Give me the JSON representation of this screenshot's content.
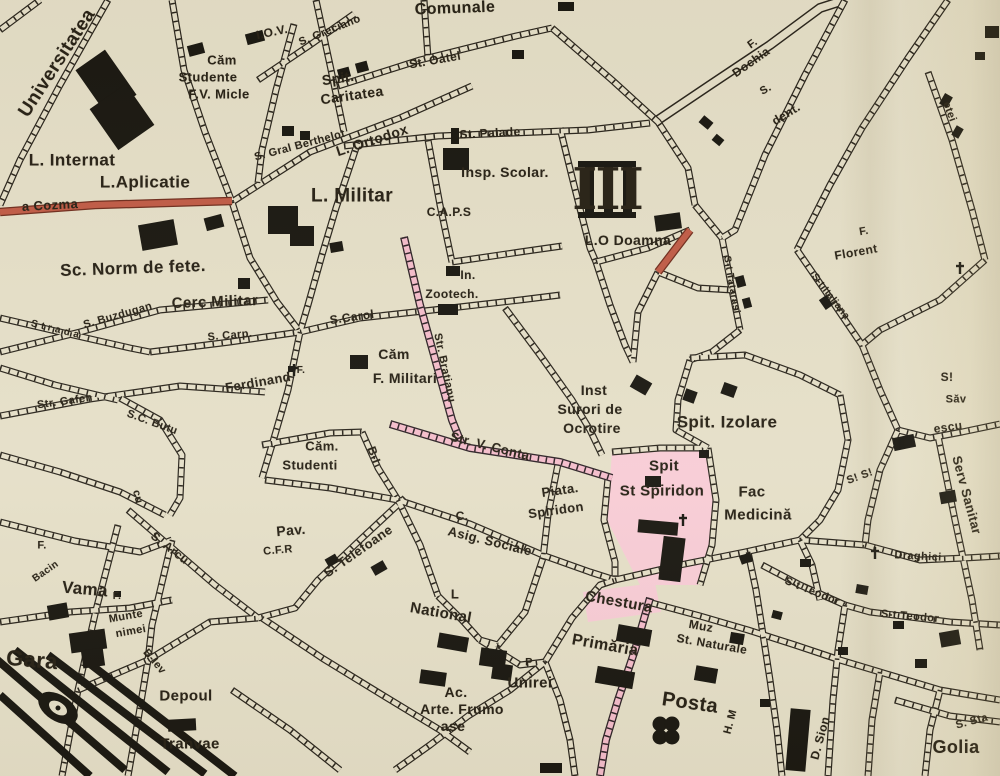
{
  "map": {
    "title": "Vintage city map sheet (Iasi) - district III",
    "background_color": "#e5dfc8",
    "ink_color": "#27221a",
    "highlight_pink_street": "#f4bccb",
    "highlight_pink_area": "#f8ccd6",
    "road_red": "#c05a45",
    "labels": [
      {
        "name": "label-universitatea",
        "t": "Universitatea",
        "x": 57,
        "y": 63,
        "r": -57,
        "s": 19
      },
      {
        "name": "label-iov",
        "t": "I.O.V.",
        "x": 272,
        "y": 32,
        "r": -12,
        "s": 12
      },
      {
        "name": "label-cam-studente-1",
        "t": "Căm",
        "x": 222,
        "y": 60,
        "r": 0,
        "s": 13
      },
      {
        "name": "label-cam-studente-2",
        "t": "Studente",
        "x": 208,
        "y": 77,
        "r": 0,
        "s": 13
      },
      {
        "name": "label-cam-studente-3",
        "t": "F.V. Micle",
        "x": 219,
        "y": 94,
        "r": 0,
        "s": 13
      },
      {
        "name": "label-l-internat",
        "t": "L. Internat",
        "x": 72,
        "y": 160,
        "r": 0,
        "s": 17
      },
      {
        "name": "label-l-aplicatie",
        "t": "L.Aplicatie",
        "x": 145,
        "y": 182,
        "r": 0,
        "s": 17
      },
      {
        "name": "street-name-a-cozma",
        "t": "a Cozma",
        "x": 50,
        "y": 205,
        "r": -3,
        "s": 13
      },
      {
        "name": "label-sc-norm-de-fete",
        "t": "Sc. Norm de fete.",
        "x": 133,
        "y": 268,
        "r": -2,
        "s": 17
      },
      {
        "name": "label-cerc-militar",
        "t": "Cerc Militar",
        "x": 215,
        "y": 302,
        "r": -2,
        "s": 15
      },
      {
        "name": "label-comunale",
        "t": "Comunale",
        "x": 455,
        "y": 9,
        "r": -2,
        "s": 16
      },
      {
        "name": "street-name-greciano",
        "t": "S. Greciano",
        "x": 330,
        "y": 31,
        "r": -22,
        "s": 11
      },
      {
        "name": "label-spit-caritatea-1",
        "t": "Spit.",
        "x": 338,
        "y": 78,
        "r": -8,
        "s": 14
      },
      {
        "name": "label-spit-caritatea-2",
        "t": "Caritatea",
        "x": 352,
        "y": 95,
        "r": -8,
        "s": 14
      },
      {
        "name": "street-name-berthelot",
        "t": "S. Gral Berthelot",
        "x": 300,
        "y": 146,
        "r": -15,
        "s": 11
      },
      {
        "name": "street-name-oatel",
        "t": "St. Oatel",
        "x": 435,
        "y": 60,
        "r": -10,
        "s": 12
      },
      {
        "name": "street-name-palade",
        "t": "St. Palade",
        "x": 490,
        "y": 133,
        "r": -3,
        "s": 12
      },
      {
        "name": "label-l-ortodox",
        "t": "L. Ortodox",
        "x": 372,
        "y": 140,
        "r": -18,
        "s": 14
      },
      {
        "name": "label-l-militar",
        "t": "L. Militar",
        "x": 352,
        "y": 196,
        "r": 0,
        "s": 19
      },
      {
        "name": "label-insp-scolar",
        "t": "Insp. Scolar.",
        "x": 505,
        "y": 172,
        "r": 0,
        "s": 14
      },
      {
        "name": "label-district-iii",
        "t": "III",
        "x": 607,
        "y": 189,
        "r": 0,
        "s": 54,
        "serif": true
      },
      {
        "name": "label-lo-doamna",
        "t": "L.O Doamna",
        "x": 628,
        "y": 240,
        "r": 0,
        "s": 14
      },
      {
        "name": "label-f-dochia-1",
        "t": "F.",
        "x": 753,
        "y": 44,
        "r": -35,
        "s": 11
      },
      {
        "name": "label-f-dochia-2",
        "t": "Dochia",
        "x": 751,
        "y": 62,
        "r": -35,
        "s": 12
      },
      {
        "name": "label-s-dent-1",
        "t": "S.",
        "x": 766,
        "y": 90,
        "r": -30,
        "s": 11
      },
      {
        "name": "label-s-dent-2",
        "t": "dent.",
        "x": 786,
        "y": 114,
        "r": -32,
        "s": 12
      },
      {
        "name": "street-name-etei",
        "t": "etei",
        "x": 949,
        "y": 112,
        "r": 70,
        "s": 11
      },
      {
        "name": "label-f-florent-1",
        "t": "F.",
        "x": 864,
        "y": 232,
        "r": -10,
        "s": 11
      },
      {
        "name": "label-f-florent-2",
        "t": "Florent",
        "x": 856,
        "y": 252,
        "r": -10,
        "s": 12
      },
      {
        "name": "label-caps",
        "t": "C.A.P.S",
        "x": 449,
        "y": 212,
        "r": 0,
        "s": 12
      },
      {
        "name": "label-in-zootech-1",
        "t": "In.",
        "x": 468,
        "y": 275,
        "r": 0,
        "s": 12
      },
      {
        "name": "label-in-zootech-2",
        "t": "Zootech.",
        "x": 452,
        "y": 294,
        "r": 0,
        "s": 12
      },
      {
        "name": "street-name-carol",
        "t": "S.Carol",
        "x": 352,
        "y": 317,
        "r": -8,
        "s": 12
      },
      {
        "name": "street-name-buzdugan",
        "t": "S. Buzdugan",
        "x": 118,
        "y": 316,
        "r": -16,
        "s": 11
      },
      {
        "name": "street-name-carp",
        "t": "S. Carp.",
        "x": 230,
        "y": 336,
        "r": -5,
        "s": 11
      },
      {
        "name": "street-name-strada",
        "t": "S t r a d a",
        "x": 55,
        "y": 330,
        "r": 14,
        "s": 10
      },
      {
        "name": "label-ferdinand",
        "t": "Ferdinand",
        "x": 258,
        "y": 382,
        "r": -10,
        "s": 13
      },
      {
        "name": "label-f-ferdinand",
        "t": "F.",
        "x": 301,
        "y": 371,
        "r": 0,
        "s": 10
      },
      {
        "name": "label-cam-f-militari-1",
        "t": "Căm",
        "x": 394,
        "y": 354,
        "r": 0,
        "s": 14
      },
      {
        "name": "label-cam-f-militari-2",
        "t": "F. Militari",
        "x": 405,
        "y": 378,
        "r": 0,
        "s": 14
      },
      {
        "name": "street-name-bratianu",
        "t": "Str. Bratianu",
        "x": 444,
        "y": 368,
        "r": 78,
        "s": 11
      },
      {
        "name": "street-name-v-conta",
        "t": "Str. V. Conta",
        "x": 490,
        "y": 446,
        "r": 14,
        "s": 13
      },
      {
        "name": "label-inst-surori-1",
        "t": "Inst",
        "x": 594,
        "y": 390,
        "r": 0,
        "s": 14
      },
      {
        "name": "label-inst-surori-2",
        "t": "Surori de",
        "x": 590,
        "y": 409,
        "r": 0,
        "s": 14
      },
      {
        "name": "label-inst-surori-3",
        "t": "Ocrotire",
        "x": 592,
        "y": 428,
        "r": 0,
        "s": 14
      },
      {
        "name": "label-spit-izolare",
        "t": "Spit. Izolare",
        "x": 727,
        "y": 422,
        "r": 0,
        "s": 17
      },
      {
        "name": "label-spit-spiridon-1",
        "t": "Spit",
        "x": 664,
        "y": 466,
        "r": 0,
        "s": 15
      },
      {
        "name": "label-spit-spiridon-2",
        "t": "St Spiridon",
        "x": 662,
        "y": 491,
        "r": 0,
        "s": 15
      },
      {
        "name": "label-fac-medicina-1",
        "t": "Fac",
        "x": 752,
        "y": 492,
        "r": 0,
        "s": 15
      },
      {
        "name": "label-fac-medicina-2",
        "t": "Medicină",
        "x": 758,
        "y": 515,
        "r": 0,
        "s": 15
      },
      {
        "name": "street-name-tatarasi",
        "t": "S-t Tatarasi",
        "x": 731,
        "y": 285,
        "r": 80,
        "s": 10
      },
      {
        "name": "street-name-italiana",
        "t": "S-t Italiana",
        "x": 830,
        "y": 297,
        "r": 52,
        "s": 10
      },
      {
        "name": "street-fragment-s1",
        "t": "S!",
        "x": 947,
        "y": 377,
        "r": 0,
        "s": 12
      },
      {
        "name": "label-sav",
        "t": "Săv",
        "x": 956,
        "y": 400,
        "r": 0,
        "s": 11
      },
      {
        "name": "label-escu",
        "t": "escu",
        "x": 948,
        "y": 427,
        "r": -8,
        "s": 12
      },
      {
        "name": "street-name-serv-sanitar",
        "t": "Serv Sanitar",
        "x": 967,
        "y": 495,
        "r": 75,
        "s": 13
      },
      {
        "name": "street-fragment-s2",
        "t": "S! S!",
        "x": 860,
        "y": 477,
        "r": -20,
        "s": 11
      },
      {
        "name": "street-name-draghici",
        "t": "Draghici",
        "x": 918,
        "y": 557,
        "r": 3,
        "s": 11
      },
      {
        "name": "label-cam-studenti-1",
        "t": "Căm.",
        "x": 322,
        "y": 446,
        "r": 0,
        "s": 13
      },
      {
        "name": "label-cam-studenti-2",
        "t": "Studenti",
        "x": 310,
        "y": 465,
        "r": 0,
        "s": 13
      },
      {
        "name": "street-name-b-i",
        "t": "B-I",
        "x": 374,
        "y": 455,
        "r": 70,
        "s": 12
      },
      {
        "name": "label-pav-cfr-1",
        "t": "Pav.",
        "x": 291,
        "y": 530,
        "r": -5,
        "s": 14
      },
      {
        "name": "label-pav-cfr-2",
        "t": "C.F.R",
        "x": 278,
        "y": 551,
        "r": -5,
        "s": 11
      },
      {
        "name": "street-name-telefoane",
        "t": "S. Telefoane",
        "x": 358,
        "y": 551,
        "r": -35,
        "s": 13
      },
      {
        "name": "street-name-gafen",
        "t": "Str. Gafen",
        "x": 65,
        "y": 402,
        "r": -8,
        "s": 11
      },
      {
        "name": "street-name-butu",
        "t": "S.C. Butu",
        "x": 152,
        "y": 423,
        "r": 20,
        "s": 11
      },
      {
        "name": "street-fragment-cu",
        "t": "cu",
        "x": 137,
        "y": 497,
        "r": 75,
        "s": 11
      },
      {
        "name": "street-name-arcu",
        "t": "S. Arcu",
        "x": 170,
        "y": 548,
        "r": 38,
        "s": 12
      },
      {
        "name": "label-f-bacin-1",
        "t": "F.",
        "x": 42,
        "y": 546,
        "r": 0,
        "s": 11
      },
      {
        "name": "label-f-bacin-2",
        "t": "Bacin",
        "x": 46,
        "y": 572,
        "r": -35,
        "s": 10
      },
      {
        "name": "label-vama",
        "t": "Vama",
        "x": 85,
        "y": 589,
        "r": 5,
        "s": 17
      },
      {
        "name": "label-f-munte",
        "t": "F.",
        "x": 117,
        "y": 597,
        "r": 0,
        "s": 10
      },
      {
        "name": "label-muntenimei-1",
        "t": "Munte",
        "x": 126,
        "y": 617,
        "r": -10,
        "s": 11
      },
      {
        "name": "label-muntenimei-2",
        "t": "nimei",
        "x": 131,
        "y": 632,
        "r": -10,
        "s": 11
      },
      {
        "name": "label-gara",
        "t": "Gara",
        "x": 32,
        "y": 660,
        "r": 5,
        "s": 22
      },
      {
        "name": "street-name-b-lev",
        "t": "B-lev",
        "x": 154,
        "y": 662,
        "r": 50,
        "s": 11
      },
      {
        "name": "label-depoul-1",
        "t": "Depoul",
        "x": 186,
        "y": 696,
        "r": 0,
        "s": 15
      },
      {
        "name": "label-depoul-2",
        "t": "Tranvae",
        "x": 190,
        "y": 744,
        "r": 0,
        "s": 15
      },
      {
        "name": "label-national-1",
        "t": "L",
        "x": 455,
        "y": 594,
        "r": 0,
        "s": 13
      },
      {
        "name": "label-national-2",
        "t": "National",
        "x": 441,
        "y": 613,
        "r": 10,
        "s": 15
      },
      {
        "name": "label-arte-frumoase-1",
        "t": "Ac.",
        "x": 456,
        "y": 692,
        "r": 0,
        "s": 14
      },
      {
        "name": "label-arte-frumoase-2",
        "t": "Arte. Frumo",
        "x": 462,
        "y": 709,
        "r": 0,
        "s": 14
      },
      {
        "name": "label-arte-frumoase-3",
        "t": "ase",
        "x": 453,
        "y": 726,
        "r": 0,
        "s": 14
      },
      {
        "name": "label-piata-unirei-p",
        "t": "P",
        "x": 529,
        "y": 663,
        "r": 0,
        "s": 11
      },
      {
        "name": "label-unirei",
        "t": "Unirei",
        "x": 530,
        "y": 683,
        "r": 0,
        "s": 15
      },
      {
        "name": "label-chestura",
        "t": "Chestura",
        "x": 619,
        "y": 602,
        "r": 10,
        "s": 15
      },
      {
        "name": "label-primaria",
        "t": "Primăria",
        "x": 605,
        "y": 646,
        "r": 10,
        "s": 16
      },
      {
        "name": "label-muz-naturale-1",
        "t": "Muz",
        "x": 701,
        "y": 626,
        "r": 10,
        "s": 12
      },
      {
        "name": "label-muz-naturale-2",
        "t": "St. Naturale",
        "x": 712,
        "y": 644,
        "r": 10,
        "s": 12
      },
      {
        "name": "label-posta",
        "t": "Posta",
        "x": 690,
        "y": 703,
        "r": 8,
        "s": 20
      },
      {
        "name": "street-fragment-h-m",
        "t": "H. M",
        "x": 731,
        "y": 722,
        "r": -75,
        "s": 11
      },
      {
        "name": "street-name-d-sion",
        "t": "D. Sion",
        "x": 820,
        "y": 738,
        "r": -75,
        "s": 12
      },
      {
        "name": "street-name-teodor-1",
        "t": "S-t Teodor",
        "x": 812,
        "y": 592,
        "r": 22,
        "s": 11
      },
      {
        "name": "street-name-teodor-2",
        "t": "S-t Teodor",
        "x": 910,
        "y": 617,
        "r": 5,
        "s": 11
      },
      {
        "name": "street-fragment-sta",
        "t": "S. Sta",
        "x": 972,
        "y": 722,
        "r": -15,
        "s": 11
      },
      {
        "name": "label-golia",
        "t": "Golia",
        "x": 956,
        "y": 747,
        "r": 0,
        "s": 18
      },
      {
        "name": "label-piata-spiridon-1",
        "t": "Piata.",
        "x": 560,
        "y": 490,
        "r": -8,
        "s": 13
      },
      {
        "name": "label-piata-spiridon-2",
        "t": "Spiridon",
        "x": 556,
        "y": 510,
        "r": -8,
        "s": 13
      },
      {
        "name": "label-asig-sociale-1",
        "t": "C.",
        "x": 462,
        "y": 516,
        "r": 0,
        "s": 12
      },
      {
        "name": "label-asig-sociale-2",
        "t": "Asig. Sociale",
        "x": 490,
        "y": 541,
        "r": 14,
        "s": 13
      }
    ]
  }
}
